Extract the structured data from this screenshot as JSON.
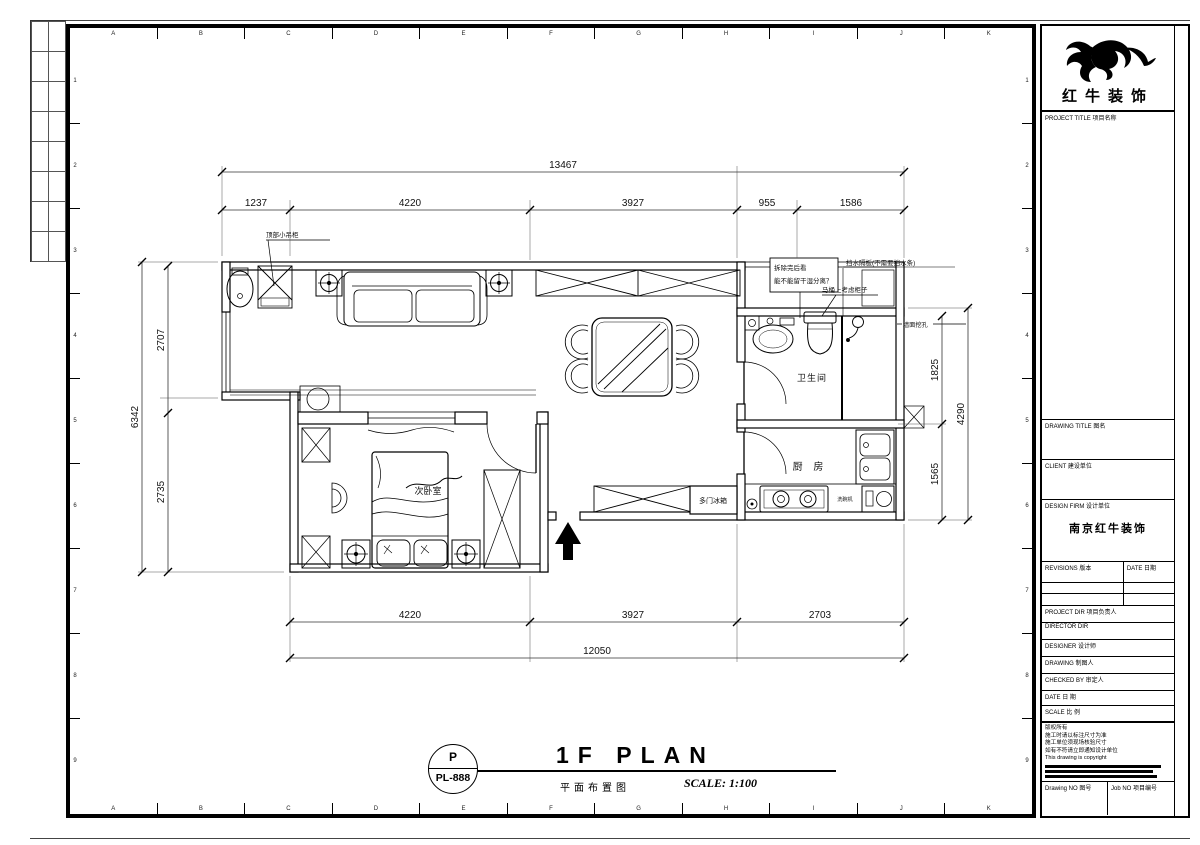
{
  "sheet": {
    "grid_letters": [
      "A",
      "B",
      "C",
      "D",
      "E",
      "F",
      "G",
      "H",
      "I",
      "J",
      "K"
    ],
    "grid_numbers": [
      "1",
      "2",
      "3",
      "4",
      "5",
      "6",
      "7",
      "8",
      "9"
    ]
  },
  "plan": {
    "rooms": {
      "bathroom": "卫生间",
      "kitchen": "厨 房",
      "bedroom": "次卧室",
      "fridge": "多门冰箱",
      "dishwasher": "洗碗机"
    },
    "annotations": {
      "top_cabinet": "顶部小吊柜",
      "demo_note1": "拆除完后看",
      "demo_note2": "能不能留干湿分离？",
      "water_baffle": "挡水隔板(不需要挡水条)",
      "toilet_cabinet": "马桶上考虑柜子",
      "wall_hole": "墙面挖孔"
    },
    "dims": {
      "top": {
        "total": "13467",
        "segments": [
          "1237",
          "4220",
          "3927",
          "955",
          "1586"
        ]
      },
      "bottom": {
        "total": "12050",
        "segments": [
          "4220",
          "3927",
          "2703"
        ]
      },
      "left": {
        "total": "6342",
        "segments": [
          "2707",
          "2735"
        ]
      },
      "right": {
        "total": "4290",
        "segments": [
          "1825",
          "1565"
        ]
      }
    }
  },
  "sheet_title": {
    "tag_top": "P",
    "tag_bottom": "PL-888",
    "title": "1F PLAN",
    "subtitle": "平面布置图",
    "scale": "SCALE: 1:100"
  },
  "title_block": {
    "logo_text": "红牛装饰",
    "project_title": "PROJECT TITLE  项目名称",
    "drawing_title": "DRAWING TITLE  图名",
    "client": "CLIENT  建设单位",
    "design_firm": "DESIGN FIRM  设计单位",
    "firm_name": "南京红牛装饰",
    "revisions": "REVISIONS  版本",
    "revisions_date": "DATE  日期",
    "project_dir": "PROJECT DIR  项目负责人",
    "director": "DIRECTOR DIR",
    "designer": "DESIGNER  设计师",
    "drawing": "DRAWING  制图人",
    "checked_by": "CHECKED BY  审定人",
    "date": "DATE  日 期",
    "scale": "SCALE  比 例",
    "notes": [
      "版权所有",
      "施工时请以标注尺寸为准",
      "施工单位须现场核验尺寸",
      "如有不符请立即通知设计单位",
      "This drawing is copyright"
    ],
    "drawing_no": "Drawing NO  图号",
    "job_no": "Job NO  项目编号"
  }
}
